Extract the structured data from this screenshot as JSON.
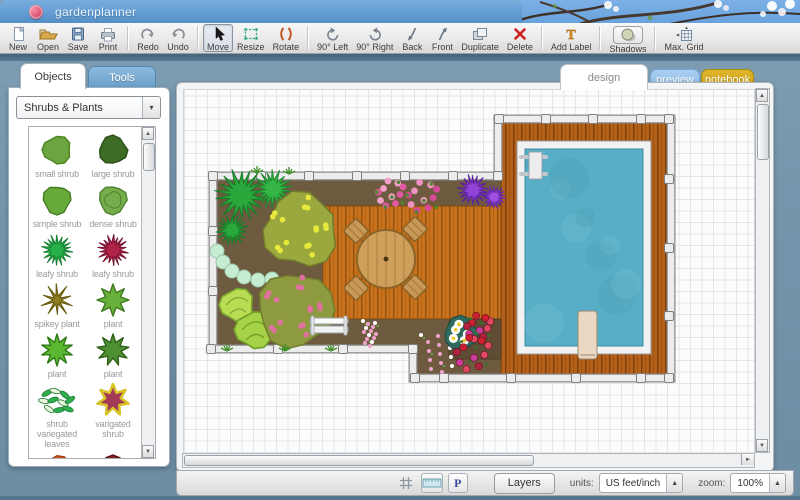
{
  "window": {
    "title": "gardenplanner"
  },
  "toolbar": {
    "groups": [
      {
        "items": [
          {
            "id": "new",
            "label": "New"
          },
          {
            "id": "open",
            "label": "Open"
          },
          {
            "id": "save",
            "label": "Save"
          },
          {
            "id": "print",
            "label": "Print"
          }
        ]
      },
      {
        "items": [
          {
            "id": "redo",
            "label": "Redo"
          },
          {
            "id": "undo",
            "label": "Undo"
          }
        ]
      },
      {
        "items": [
          {
            "id": "move",
            "label": "Move",
            "selected": true
          },
          {
            "id": "resize",
            "label": "Resize"
          },
          {
            "id": "rotate",
            "label": "Rotate"
          }
        ]
      },
      {
        "items": [
          {
            "id": "rot90l",
            "label": "90° Left"
          },
          {
            "id": "rot90r",
            "label": "90° Right"
          },
          {
            "id": "back",
            "label": "Back"
          },
          {
            "id": "front",
            "label": "Front"
          },
          {
            "id": "duplicate",
            "label": "Duplicate"
          },
          {
            "id": "delete",
            "label": "Delete"
          }
        ]
      },
      {
        "items": [
          {
            "id": "addlabel",
            "label": "Add Label"
          }
        ]
      },
      {
        "items": [
          {
            "id": "shadows",
            "label": "Shadows",
            "boxed": true
          }
        ]
      },
      {
        "items": [
          {
            "id": "maxgrid",
            "label": "Max. Grid"
          }
        ]
      }
    ]
  },
  "sidebar": {
    "tabs": [
      {
        "id": "objects",
        "label": "Objects",
        "active": true
      },
      {
        "id": "tools",
        "label": "Tools",
        "active": false
      }
    ],
    "category_select": {
      "value": "Shrubs & Plants"
    },
    "plants": [
      {
        "label": "small shrub",
        "icon": {
          "t": "blob",
          "c": "#6ca43f",
          "s": "#49841f",
          "seed": 3
        }
      },
      {
        "label": "large shrub",
        "icon": {
          "t": "blob",
          "c": "#3e6b26",
          "s": "#2b4f16",
          "seed": 5
        }
      },
      {
        "label": "simple shrub",
        "icon": {
          "t": "blob",
          "c": "#66ab39",
          "s": "#447c22",
          "seed": 7
        }
      },
      {
        "label": "dense shrub",
        "icon": {
          "t": "blobring",
          "c": "#74ad49",
          "s": "#4e8230",
          "seed": 4
        }
      },
      {
        "label": "leafy shrub",
        "icon": {
          "t": "burst",
          "c": "#27b04a",
          "s": "#14802e",
          "seed": 6
        }
      },
      {
        "label": "leafy shrub",
        "icon": {
          "t": "burst",
          "c": "#b02448",
          "s": "#771230",
          "seed": 8
        }
      },
      {
        "label": "spikey plant",
        "icon": {
          "t": "spiky",
          "c": "#8f7d20",
          "s": "#66590e",
          "seed": 5
        }
      },
      {
        "label": "plant",
        "icon": {
          "t": "star",
          "c": "#68b03c",
          "s": "#3f7a1f",
          "n": 8
        }
      },
      {
        "label": "plant",
        "icon": {
          "t": "star",
          "c": "#5cb832",
          "s": "#2f7a16",
          "n": 10
        }
      },
      {
        "label": "plant",
        "icon": {
          "t": "star",
          "c": "#4f8f33",
          "s": "#2e6017",
          "n": 9
        }
      },
      {
        "label": "shrub variegated leaves",
        "icon": {
          "t": "leaves",
          "c": "#2fae4e",
          "c2": "#eaf5da",
          "s": "#1f7c34"
        }
      },
      {
        "label": "varigated shrub",
        "icon": {
          "t": "star",
          "c": "#a33b58",
          "s": "#d8c426",
          "n": 7,
          "sw": 2.5
        }
      },
      {
        "label": "",
        "icon": {
          "t": "blob",
          "c": "#d85a20",
          "s": "#a03810",
          "seed": 9
        },
        "partial": true
      },
      {
        "label": "",
        "icon": {
          "t": "blob",
          "c": "#8a2020",
          "s": "#5c1010",
          "seed": 2
        },
        "partial": true
      }
    ]
  },
  "canvas": {
    "tabs": [
      {
        "id": "design",
        "label": "design",
        "active": true
      },
      {
        "id": "preview",
        "label": "preview"
      },
      {
        "id": "notebook",
        "label": "notebook"
      }
    ]
  },
  "bottombar": {
    "p_label": "P",
    "layers": "Layers",
    "units_label": "units:",
    "units_value": "US feet/inch",
    "zoom_label": "zoom:",
    "zoom_value": "100%"
  },
  "colors": {
    "titlebar": "#639dd2",
    "deck_light": "#c9721c",
    "deck_dark": "#b2601a",
    "soil": "#6e5a3e",
    "pool_water": "#58aec6",
    "edging": "#ececec"
  },
  "garden": {
    "plot": [
      [
        36,
        93
      ],
      [
        321,
        93
      ],
      [
        321,
        36
      ],
      [
        494,
        36
      ],
      [
        494,
        295
      ],
      [
        236,
        295
      ],
      [
        236,
        266
      ],
      [
        36,
        266
      ]
    ],
    "decks": [
      {
        "x": 146,
        "y": 123,
        "w": 178,
        "h": 113,
        "tone": "light"
      },
      {
        "x": 324,
        "y": 40,
        "w": 166,
        "h": 251,
        "tone": "dark"
      }
    ],
    "pool": {
      "frame": [
        340,
        58,
        134,
        213
      ],
      "water": [
        348,
        66,
        118,
        197
      ],
      "board": [
        401,
        228,
        19,
        48
      ]
    },
    "posts": [
      [
        36,
        93
      ],
      [
        84,
        93
      ],
      [
        132,
        93
      ],
      [
        180,
        93
      ],
      [
        228,
        93
      ],
      [
        276,
        93
      ],
      [
        321,
        93
      ],
      [
        322,
        36
      ],
      [
        369,
        36
      ],
      [
        416,
        36
      ],
      [
        464,
        36
      ],
      [
        492,
        36
      ],
      [
        492,
        96
      ],
      [
        492,
        165
      ],
      [
        492,
        233
      ],
      [
        492,
        295
      ],
      [
        464,
        295
      ],
      [
        399,
        295
      ],
      [
        334,
        295
      ],
      [
        267,
        295
      ],
      [
        238,
        295
      ],
      [
        236,
        266
      ],
      [
        166,
        266
      ],
      [
        101,
        266
      ],
      [
        34,
        266
      ],
      [
        36,
        148
      ],
      [
        36,
        208
      ]
    ],
    "objects": [
      {
        "t": "burst",
        "x": 64,
        "y": 112,
        "r": 27,
        "c": "#2aa83c",
        "s": "#177c28",
        "seed": 2
      },
      {
        "t": "burst",
        "x": 96,
        "y": 106,
        "r": 20,
        "c": "#35b545",
        "s": "#1c8a2e",
        "seed": 5
      },
      {
        "t": "burst",
        "x": 55,
        "y": 147,
        "r": 16,
        "c": "#2aa83c",
        "s": "#177c28",
        "seed": 7
      },
      {
        "t": "tree",
        "x": 124,
        "y": 147,
        "r": 40,
        "c": "#9aa83e",
        "dot": "#e6e93c",
        "sq": "#7e9448",
        "seed": 3
      },
      {
        "t": "stones",
        "pts": [
          [
            40,
            168
          ],
          [
            46,
            179
          ],
          [
            55,
            188
          ],
          [
            67,
            194
          ],
          [
            81,
            197
          ],
          [
            95,
            196
          ]
        ],
        "r": 7,
        "c": "#c6ecd2",
        "s": "#9cc8aa"
      },
      {
        "t": "cabbage",
        "x": 60,
        "y": 222,
        "r": 18,
        "c": "#b8dc52",
        "s": "#7ca830"
      },
      {
        "t": "cabbage",
        "x": 77,
        "y": 247,
        "r": 20,
        "c": "#a6d248",
        "s": "#6f9e28"
      },
      {
        "t": "tree",
        "x": 118,
        "y": 227,
        "r": 40,
        "c": "#8e9a40",
        "dot": "#e0719e",
        "sq": "#6d8a3c",
        "seed": 8
      },
      {
        "t": "flowers",
        "x": 214,
        "y": 110,
        "r": 15,
        "c": "#e058a0",
        "c2": "#f2a0c8",
        "s": "#4a8a2a"
      },
      {
        "t": "flowers",
        "x": 246,
        "y": 113,
        "r": 17,
        "c": "#d84a96",
        "c2": "#ef94c2",
        "s": "#4a8a2a"
      },
      {
        "t": "burst",
        "x": 296,
        "y": 107,
        "r": 16,
        "c": "#9344d8",
        "s": "#5c20a0",
        "seed": 4
      },
      {
        "t": "burst",
        "x": 317,
        "y": 114,
        "r": 12,
        "c": "#a050e0",
        "s": "#6a28b0",
        "seed": 6
      },
      {
        "t": "tableset",
        "x": 209,
        "y": 176,
        "r": 29
      },
      {
        "t": "bench",
        "x": 152,
        "y": 243,
        "w": 38,
        "h": 17
      },
      {
        "t": "soilpatch",
        "x": 272,
        "y": 236,
        "w": 52,
        "h": 40
      },
      {
        "t": "scatter",
        "x": 186,
        "y": 238,
        "w": 52,
        "h": 26
      },
      {
        "t": "scatter",
        "x": 244,
        "y": 252,
        "w": 32,
        "h": 40
      },
      {
        "t": "daisies",
        "x": 284,
        "y": 250,
        "r": 18
      },
      {
        "t": "roses",
        "x": 302,
        "y": 244,
        "r": 14
      },
      {
        "t": "roses",
        "x": 296,
        "y": 270,
        "r": 19
      },
      {
        "t": "tuft",
        "x": 80,
        "y": 90
      },
      {
        "t": "tuft",
        "x": 112,
        "y": 91
      },
      {
        "t": "tuft",
        "x": 50,
        "y": 268
      },
      {
        "t": "tuft",
        "x": 108,
        "y": 268
      },
      {
        "t": "tuft",
        "x": 154,
        "y": 268
      }
    ]
  }
}
